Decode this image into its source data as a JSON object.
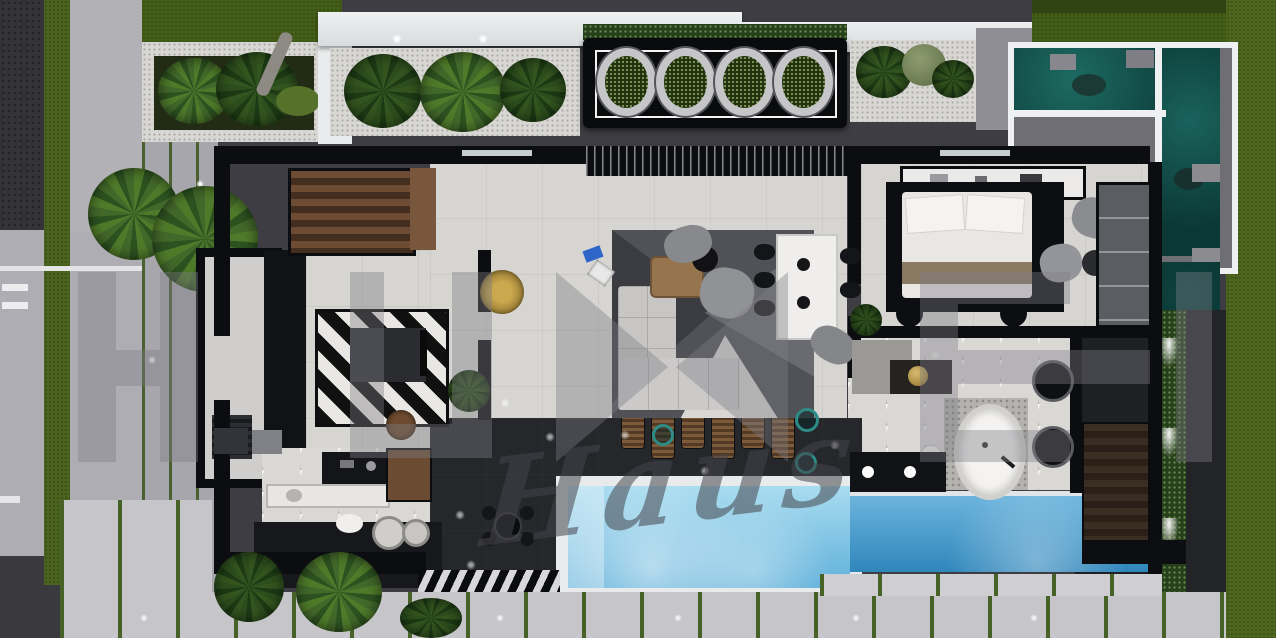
{
  "watermark": {
    "script_text": "Haus"
  },
  "palette": {
    "lawn_green": "#4c671d",
    "pool_blue": "#6fbce2",
    "pond_teal": "#14534f",
    "floor_light": "#d6d5d2",
    "terrace_dark": "#25272b",
    "wall_black": "#0c0d10",
    "wood_brown": "#6d4c33",
    "brass_gold": "#c2a24e"
  },
  "entry_planter": {
    "pot_count": 4
  },
  "pool_loungers": {
    "count": 6
  },
  "hedge_uplights": {
    "count": 3
  },
  "walkway_lights": {
    "count": 6
  }
}
